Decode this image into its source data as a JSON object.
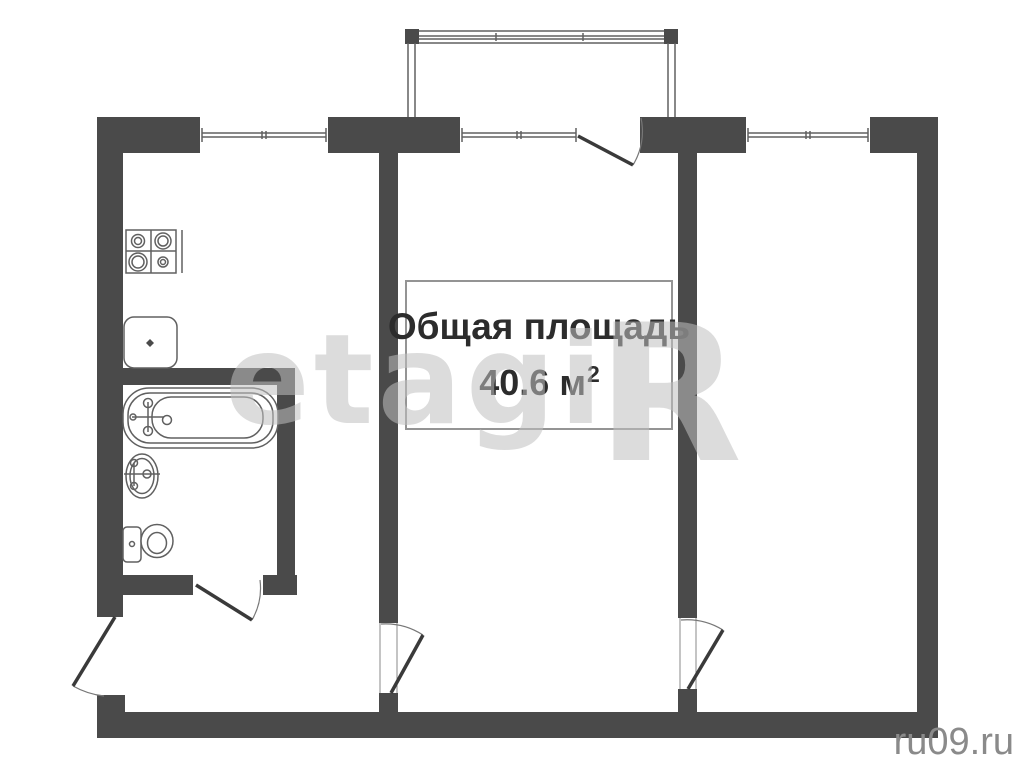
{
  "page": {
    "width": 1024,
    "height": 768,
    "background": "#ffffff"
  },
  "area_label": {
    "line1": "Общая площадь",
    "value": "40.6",
    "unit": "м",
    "superscript": "2",
    "text_color": "#2c2c2c",
    "border_color": "#949494"
  },
  "watermark": {
    "brand_text": "etagi",
    "brand_initial": "R",
    "color": "#c0c0c0",
    "site_text": "ru09.ru",
    "site_color": "#8a8a8a"
  },
  "plan": {
    "wall_color": "#4a4a4a",
    "line_color": "#606060",
    "door_leaf_color": "#3a3a3a",
    "door_arc_color": "#777777",
    "frame_line_color": "#8a8a8a",
    "floor_color": "#ffffff",
    "walls": [
      {
        "name": "wall-top-left",
        "x": 97,
        "y": 117,
        "w": 103,
        "h": 36
      },
      {
        "name": "wall-top-mid-left",
        "x": 328,
        "y": 117,
        "w": 132,
        "h": 36
      },
      {
        "name": "wall-top-mid-right",
        "x": 640,
        "y": 117,
        "w": 106,
        "h": 36
      },
      {
        "name": "wall-top-right",
        "x": 870,
        "y": 117,
        "w": 68,
        "h": 36
      },
      {
        "name": "wall-left",
        "x": 97,
        "y": 117,
        "w": 26,
        "h": 500
      },
      {
        "name": "wall-left-stub",
        "x": 97,
        "y": 695,
        "w": 28,
        "h": 43
      },
      {
        "name": "wall-bottom",
        "x": 97,
        "y": 712,
        "w": 841,
        "h": 26
      },
      {
        "name": "wall-right",
        "x": 917,
        "y": 117,
        "w": 21,
        "h": 621
      },
      {
        "name": "partition-kitchen-living",
        "x": 379,
        "y": 153,
        "w": 19,
        "h": 470
      },
      {
        "name": "partition-kitchen-living-stub",
        "x": 379,
        "y": 693,
        "w": 19,
        "h": 19
      },
      {
        "name": "partition-living-bedroom",
        "x": 678,
        "y": 153,
        "w": 19,
        "h": 465
      },
      {
        "name": "partition-living-bedroom-stub",
        "x": 678,
        "y": 689,
        "w": 19,
        "h": 23
      },
      {
        "name": "bathroom-wall-top",
        "x": 123,
        "y": 368,
        "w": 172,
        "h": 17
      },
      {
        "name": "bathroom-wall-right",
        "x": 277,
        "y": 385,
        "w": 18,
        "h": 208
      },
      {
        "name": "bathroom-wall-bottom-left",
        "x": 123,
        "y": 575,
        "w": 70,
        "h": 20
      },
      {
        "name": "bathroom-wall-bottom-right",
        "x": 263,
        "y": 575,
        "w": 34,
        "h": 20
      }
    ],
    "windows": [
      {
        "name": "window-kitchen",
        "x": 200,
        "y": 117,
        "w": 128,
        "h": 36
      },
      {
        "name": "window-living-room",
        "x": 460,
        "y": 117,
        "w": 118,
        "h": 36
      },
      {
        "name": "window-bedroom",
        "x": 746,
        "y": 117,
        "w": 124,
        "h": 36
      }
    ],
    "doors": [
      {
        "name": "door-balcony",
        "leaf": [
          578,
          136,
          633,
          165
        ],
        "arc": "M 633 165 A 64 64 0 0 0 641 118",
        "frames": []
      },
      {
        "name": "door-entrance",
        "leaf": [
          115,
          617,
          73,
          686
        ],
        "arc": "M 73 686 A 80 80 0 0 0 104 696",
        "frames": []
      },
      {
        "name": "door-bathroom",
        "leaf": [
          196,
          585,
          252,
          620
        ],
        "arc": "M 252 620 A 64 64 0 0 0 260 580",
        "frames": []
      },
      {
        "name": "door-kitchen",
        "leaf": [
          391,
          693,
          423,
          635
        ],
        "arc": "M 381 624 A 69 69 0 0 1 423 635",
        "frames": [
          [
            380,
            623,
            380,
            693
          ],
          [
            397,
            623,
            397,
            693
          ]
        ]
      },
      {
        "name": "door-bedroom",
        "leaf": [
          688,
          689,
          723,
          630
        ],
        "arc": "M 681 620 A 69 69 0 0 1 723 630",
        "frames": [
          [
            680,
            618,
            680,
            689
          ],
          [
            696,
            618,
            696,
            689
          ]
        ]
      }
    ],
    "fixtures": [
      {
        "name": "balcony-railing",
        "shapes": [
          {
            "t": "l",
            "x1": 407,
            "y1": 31,
            "x2": 678,
            "y2": 31
          },
          {
            "t": "l",
            "x1": 407,
            "y1": 43,
            "x2": 678,
            "y2": 43
          },
          {
            "t": "l",
            "x1": 418,
            "y1": 36,
            "x2": 667,
            "y2": 36
          },
          {
            "t": "l",
            "x1": 418,
            "y1": 39,
            "x2": 667,
            "y2": 39
          },
          {
            "t": "r",
            "x": 405,
            "y": 29,
            "w": 14,
            "h": 15,
            "f": "dark"
          },
          {
            "t": "r",
            "x": 664,
            "y": 29,
            "w": 14,
            "h": 15,
            "f": "dark"
          },
          {
            "t": "l",
            "x1": 408,
            "y1": 43,
            "x2": 408,
            "y2": 117
          },
          {
            "t": "l",
            "x1": 415,
            "y1": 43,
            "x2": 415,
            "y2": 117
          },
          {
            "t": "l",
            "x1": 668,
            "y1": 43,
            "x2": 668,
            "y2": 117
          },
          {
            "t": "l",
            "x1": 675,
            "y1": 43,
            "x2": 675,
            "y2": 117
          },
          {
            "t": "l",
            "x1": 496,
            "y1": 33,
            "x2": 496,
            "y2": 41
          },
          {
            "t": "l",
            "x1": 583,
            "y1": 33,
            "x2": 583,
            "y2": 41
          }
        ]
      },
      {
        "name": "stove",
        "shapes": [
          {
            "t": "r",
            "x": 126,
            "y": 230,
            "w": 50,
            "h": 43,
            "f": "white"
          },
          {
            "t": "l",
            "x1": 151,
            "y1": 230,
            "x2": 151,
            "y2": 273
          },
          {
            "t": "l",
            "x1": 126,
            "y1": 251,
            "x2": 176,
            "y2": 251
          },
          {
            "t": "l",
            "x1": 182,
            "y1": 230,
            "x2": 182,
            "y2": 273
          },
          {
            "t": "c",
            "x": 138,
            "y": 241,
            "r": 6.5
          },
          {
            "t": "c",
            "x": 138,
            "y": 241,
            "r": 3.5
          },
          {
            "t": "c",
            "x": 163,
            "y": 241,
            "r": 8
          },
          {
            "t": "c",
            "x": 163,
            "y": 241,
            "r": 5
          },
          {
            "t": "c",
            "x": 138,
            "y": 262,
            "r": 9
          },
          {
            "t": "c",
            "x": 138,
            "y": 262,
            "r": 6
          },
          {
            "t": "c",
            "x": 163,
            "y": 262,
            "r": 5
          },
          {
            "t": "c",
            "x": 163,
            "y": 262,
            "r": 2.5
          }
        ]
      },
      {
        "name": "kitchen-sink",
        "shapes": [
          {
            "t": "r",
            "x": 124,
            "y": 317,
            "w": 53,
            "h": 51,
            "rx": 10,
            "f": "white"
          },
          {
            "t": "p",
            "d": "M 150 339 L 154 343 L 150 347 L 146 343 Z",
            "f": "dark"
          }
        ]
      },
      {
        "name": "bathtub",
        "shapes": [
          {
            "t": "r",
            "x": 123,
            "y": 388,
            "w": 155,
            "h": 60,
            "rx": 26,
            "f": "white"
          },
          {
            "t": "r",
            "x": 128,
            "y": 393,
            "w": 145,
            "h": 50,
            "rx": 22
          },
          {
            "t": "r",
            "x": 152,
            "y": 397,
            "w": 111,
            "h": 41,
            "rx": 19
          },
          {
            "t": "l",
            "x1": 132,
            "y1": 417,
            "x2": 164,
            "y2": 417
          },
          {
            "t": "l",
            "x1": 148,
            "y1": 402,
            "x2": 148,
            "y2": 432
          },
          {
            "t": "c",
            "x": 148,
            "y": 403,
            "r": 4.5
          },
          {
            "t": "c",
            "x": 148,
            "y": 431,
            "r": 4.5
          },
          {
            "t": "c",
            "x": 133,
            "y": 417,
            "r": 3
          },
          {
            "t": "c",
            "x": 167,
            "y": 420,
            "r": 4.5
          }
        ]
      },
      {
        "name": "bathroom-sink",
        "shapes": [
          {
            "t": "e",
            "x": 142,
            "y": 476,
            "rx": 16,
            "ry": 22,
            "f": "white"
          },
          {
            "t": "e",
            "x": 142,
            "y": 476,
            "rx": 12,
            "ry": 17.5
          },
          {
            "t": "l",
            "x1": 124,
            "y1": 474,
            "x2": 160,
            "y2": 474
          },
          {
            "t": "l",
            "x1": 134,
            "y1": 463,
            "x2": 134,
            "y2": 486
          },
          {
            "t": "c",
            "x": 134,
            "y": 463,
            "r": 3.5
          },
          {
            "t": "c",
            "x": 134,
            "y": 486,
            "r": 3.5
          },
          {
            "t": "c",
            "x": 147,
            "y": 474,
            "r": 4
          }
        ]
      },
      {
        "name": "toilet",
        "shapes": [
          {
            "t": "r",
            "x": 123,
            "y": 527,
            "w": 18,
            "h": 35,
            "rx": 4,
            "f": "white"
          },
          {
            "t": "c",
            "x": 132,
            "y": 544,
            "r": 2.5
          },
          {
            "t": "e",
            "x": 157,
            "y": 541,
            "rx": 16,
            "ry": 16.5,
            "f": "white"
          },
          {
            "t": "e",
            "x": 157,
            "y": 543,
            "rx": 9.5,
            "ry": 10.5
          }
        ]
      }
    ]
  }
}
